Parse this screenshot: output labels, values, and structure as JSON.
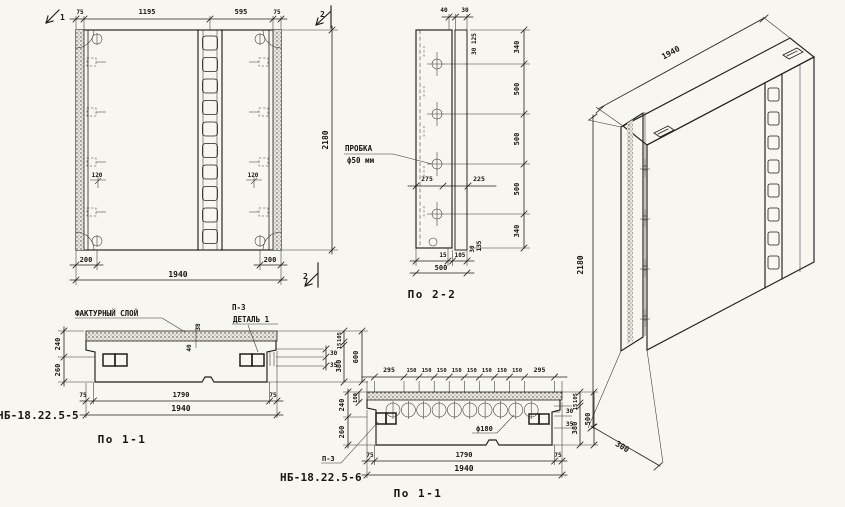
{
  "drawing": {
    "front": {
      "sec_mark_1": "1",
      "sec_mark_2_top": "2",
      "sec_mark_2_bot": "2",
      "dims_top": [
        "75",
        "1195",
        "595",
        "75"
      ],
      "dim_height": "2180",
      "dim_bottom_left": "200",
      "dim_bottom_right": "200",
      "dim_total": "1940",
      "dim_loop_left": "120",
      "dim_loop_right": "120"
    },
    "sec22": {
      "caption": "По 2-2",
      "plug_label_1": "ПРОБКА",
      "plug_label_2": "ф50 мм",
      "dim_top_a": "40",
      "dim_top_b": "30",
      "note_rot": "30 125",
      "dims_right": [
        "340",
        "500",
        "500",
        "500",
        "340"
      ],
      "dim_mid_a": "275",
      "dim_mid_b": "225",
      "dim_bot_a": "15",
      "dim_bot_b": "105",
      "dim_bot_total": "500",
      "dim_corner_a": "30",
      "dim_corner_b": "135"
    },
    "iso": {
      "dim_length": "1940",
      "dim_height": "2180",
      "dim_depth": "300"
    },
    "s11a": {
      "caption": "По 1-1",
      "mark": "НБ-18.22.5-5",
      "label_layer": "ФАКТУРНЫЙ СЛОЙ",
      "label_p3": "П-3",
      "label_detail": "ДЕТАЛЬ 1",
      "dim_left_top": "240",
      "dim_left_bot": "260",
      "dim_mid_a": "40",
      "dim_mid_b": "38",
      "dim_r1": "30",
      "dim_r2": "35",
      "dims_right_rot": [
        "105",
        "15",
        "380"
      ],
      "dim_right_total": "600",
      "dims_bottom": [
        "75",
        "1790",
        "75"
      ],
      "dim_total": "1940"
    },
    "s11b": {
      "caption": "По 1-1",
      "mark": "НБ-18.22.5-6",
      "label_p3": "П-3",
      "label_hole": "ф180",
      "dims_top": [
        "295",
        "150",
        "150",
        "150",
        "150",
        "150",
        "150",
        "150",
        "150",
        "295"
      ],
      "dim_left_top": "240",
      "dim_left_mid": "100",
      "dim_left_bot": "260",
      "dim_r1": "30",
      "dim_r2": "35",
      "dims_right_rot": [
        "105",
        "15",
        "380"
      ],
      "dim_right_total": "500",
      "dims_bottom": [
        "75",
        "1790",
        "75"
      ],
      "dim_total": "1940"
    }
  }
}
